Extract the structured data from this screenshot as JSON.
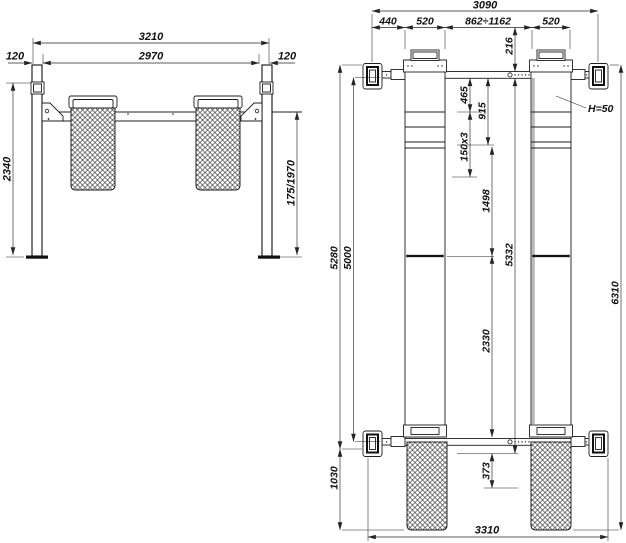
{
  "front": {
    "dim_total_width": "3210",
    "dim_inner_width": "2970",
    "dim_post_width_left": "120",
    "dim_post_width_right": "120",
    "dim_column_height": "2340",
    "dim_platform_height": "175/1970"
  },
  "plan": {
    "dim_total_width": "3090",
    "dim_seg_440": "440",
    "dim_seg_520_left": "520",
    "dim_seg_gap": "862÷1162",
    "dim_seg_520_right": "520",
    "dim_216": "216",
    "dim_465": "465",
    "dim_915": "915",
    "dim_150x3": "150x3",
    "dim_1498": "1498",
    "dim_5332": "5332",
    "dim_2330": "2330",
    "dim_373": "373",
    "dim_5280": "5280",
    "dim_5000": "5000",
    "dim_1030": "1030",
    "dim_6310": "6310",
    "dim_3310": "3310",
    "note_platform_height": "H=50"
  }
}
